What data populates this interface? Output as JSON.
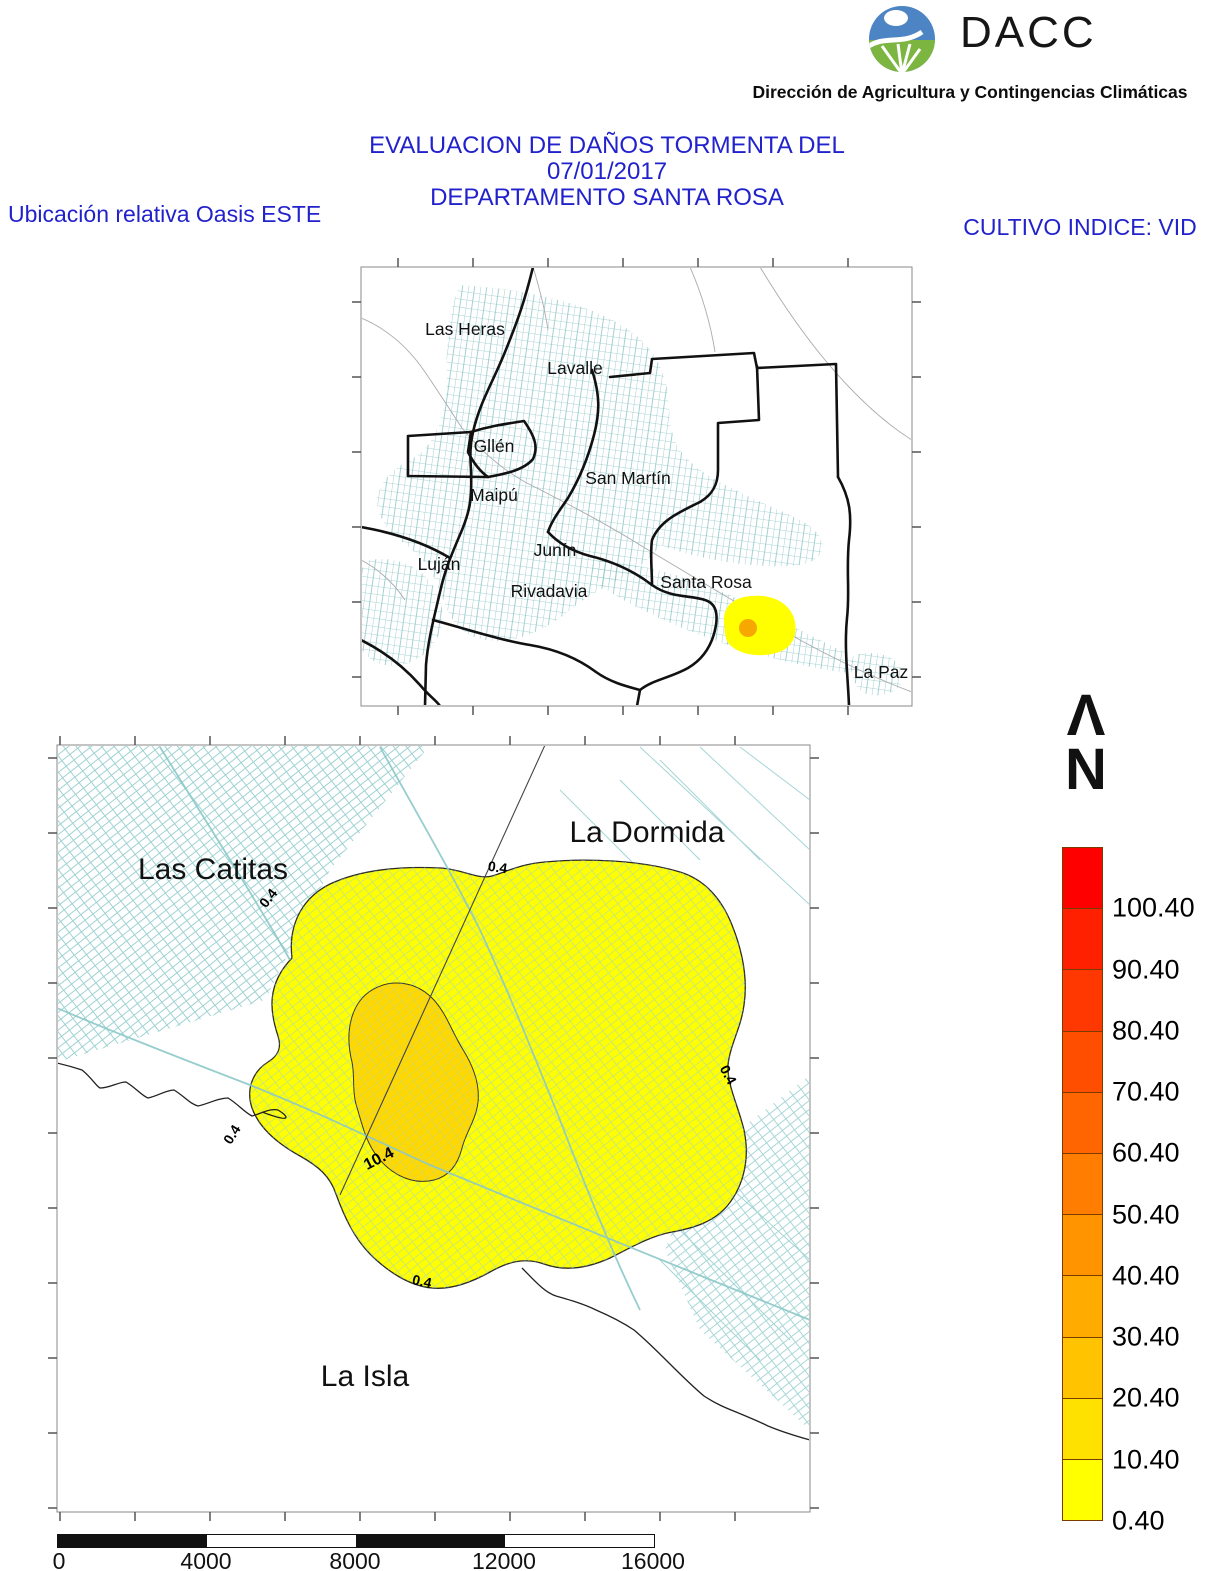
{
  "header": {
    "logo_text": "DACC",
    "logo_subtitle": "Dirección de Agricultura y Contingencias Climáticas",
    "title_line1": "EVALUACION DE DAÑOS TORMENTA DEL 07/01/2017",
    "title_line2": "DEPARTAMENTO SANTA ROSA",
    "left_label": "Ubicación relativa Oasis ESTE",
    "right_label": "CULTIVO INDICE: VID",
    "title_color": "#2222CC"
  },
  "overview_map": {
    "labels": [
      {
        "text": "Las Heras"
      },
      {
        "text": "Lavalle"
      },
      {
        "text": "Gllén"
      },
      {
        "text": "Maipú"
      },
      {
        "text": "San Martín"
      },
      {
        "text": "Junín"
      },
      {
        "text": "Luján"
      },
      {
        "text": "Rivadavia"
      },
      {
        "text": "Santa Rosa"
      },
      {
        "text": "La Paz"
      }
    ]
  },
  "detail_map": {
    "labels": [
      {
        "text": "Las Catitas"
      },
      {
        "text": "La Dormida"
      },
      {
        "text": "La Isla"
      }
    ],
    "contour_outer": "0.4",
    "contour_inner": "10.4"
  },
  "north_arrow": {
    "symbol": "Λ",
    "label": "N"
  },
  "legend": {
    "values": [
      "100.40",
      "90.40",
      "80.40",
      "70.40",
      "60.40",
      "50.40",
      "40.40",
      "30.40",
      "20.40",
      "10.40",
      "0.40"
    ],
    "colors": [
      "#FF0000",
      "#FF2000",
      "#FF3700",
      "#FF4E00",
      "#FF6500",
      "#FF7D00",
      "#FF9400",
      "#FFAB00",
      "#FFC300",
      "#FFE100",
      "#FFFF00"
    ]
  },
  "scale_bar": {
    "labels": [
      "0",
      "4000",
      "8000",
      "12000",
      "16000"
    ]
  },
  "map_colors": {
    "damage_area": "#FFFF00",
    "damage_core": "#FFD800",
    "cadastral": "#9ACFCF"
  }
}
